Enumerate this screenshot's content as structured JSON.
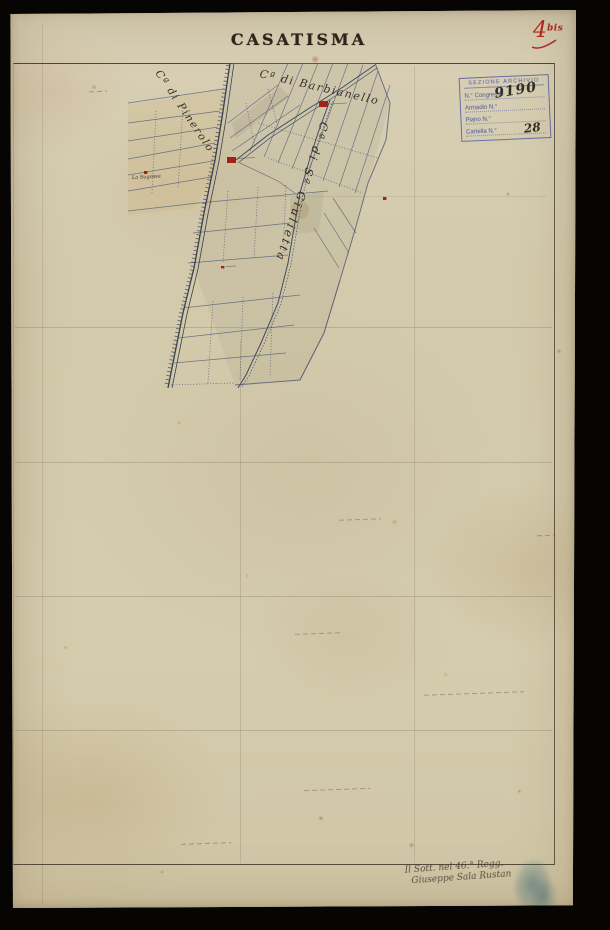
{
  "title": "CASATISMA",
  "sheet_mark": {
    "number": "4",
    "suffix": "bis"
  },
  "archive_stamp": {
    "header": "SEZIONE ARCHIVIO",
    "rows": [
      {
        "label": "N.° Congresso",
        "value": "9190"
      },
      {
        "label": "Armadio  N.°",
        "value": ""
      },
      {
        "label": "Piano      N.°",
        "value": ""
      },
      {
        "label": "Cartella  N.°",
        "value": "28"
      }
    ]
  },
  "map_labels": {
    "road_left": "Cª di Pinerolo",
    "road_top": "Cª di Barbianello",
    "road_diagonal": "Cª di Sª Giulietta",
    "farm": "La Sugossa"
  },
  "handwritten_note": {
    "line1": "Il Sott. nel 46.° Regg.",
    "line2": "Giuseppe Sala Rustan"
  },
  "colors": {
    "ink_red": "#a32119",
    "stamp_blue": "#3e4da2",
    "map_ink": "#4d5870",
    "paper": "#d2c9ab",
    "stamp_teal": "#2d6b7e"
  }
}
